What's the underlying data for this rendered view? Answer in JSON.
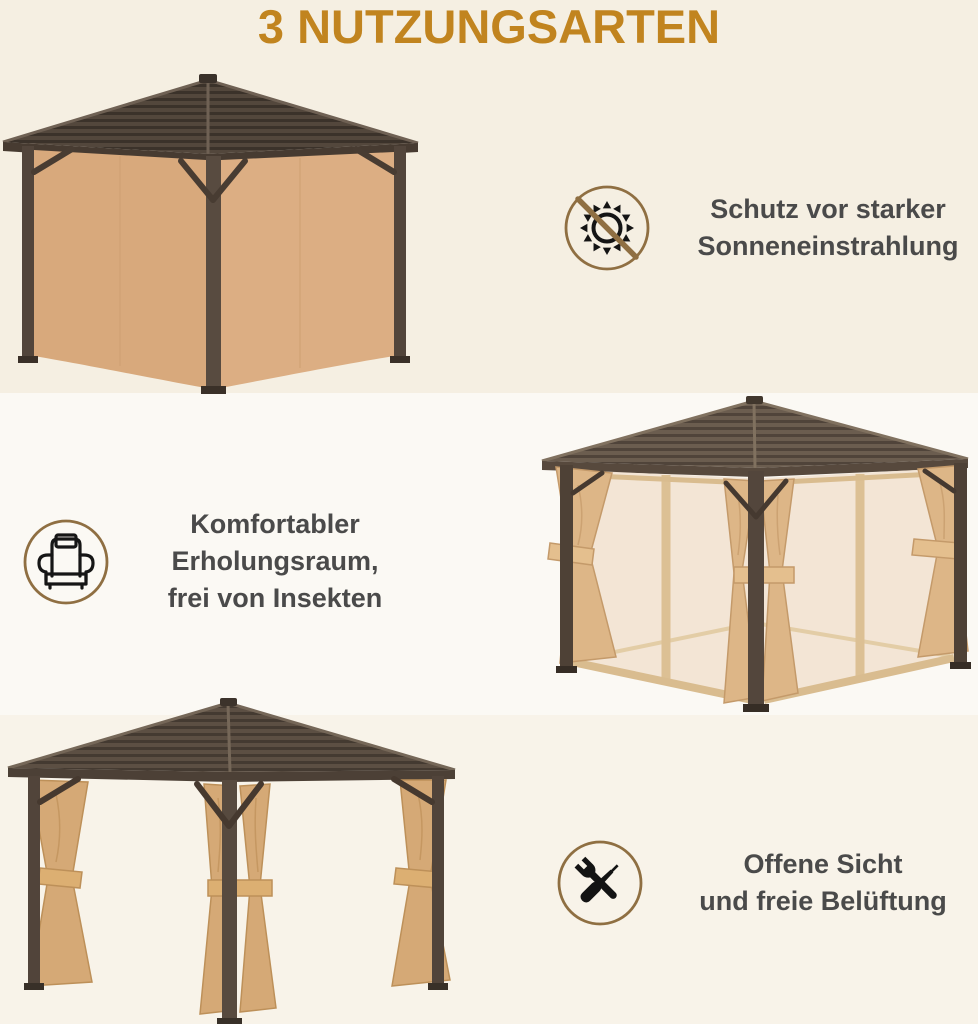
{
  "title": "3 NUTZUNGSARTEN",
  "features": [
    {
      "name": "sun-protection",
      "icon": "no-sun-icon",
      "lines": [
        "Schutz vor starker",
        "Sonneneinstrahlung"
      ]
    },
    {
      "name": "insect-free-room",
      "icon": "armchair-icon",
      "lines": [
        "Komfortabler",
        "Erholungsraum,",
        "frei von Insekten"
      ]
    },
    {
      "name": "open-view",
      "icon": "tools-icon",
      "lines": [
        "Offene Sicht",
        "und freie Belüftung"
      ]
    }
  ],
  "illustrations": [
    {
      "name": "gazebo-closed-curtains"
    },
    {
      "name": "gazebo-mesh-netting"
    },
    {
      "name": "gazebo-open-tied-curtains"
    }
  ],
  "colors": {
    "title": "#c1841f",
    "text": "#4a4a4a",
    "icon_ring": "#8f6f42",
    "icon_glyph": "#141414",
    "band_top": "#f5efe2",
    "band_middle": "#fbf9f4",
    "band_bottom": "#f8f3e9",
    "roof_dark": "#54483d",
    "frame_brown": "#483c32",
    "curtain_tan": "#d8a97c",
    "mesh_beige": "#f2e4d3"
  }
}
